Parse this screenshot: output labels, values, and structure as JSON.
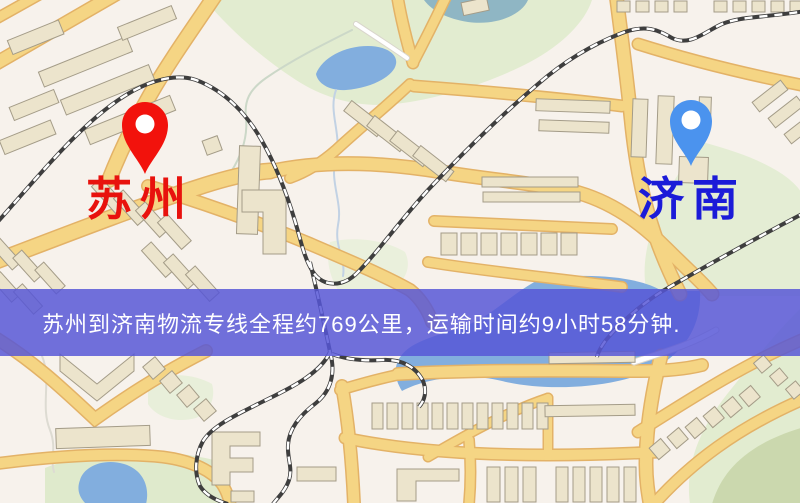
{
  "map": {
    "markers": [
      {
        "id": "origin",
        "label": "苏州",
        "label_color": "#e8120d",
        "pin_color": "#f2120c"
      },
      {
        "id": "destination",
        "label": "济南",
        "label_color": "#1b1bd8",
        "pin_color": "#4b93ee"
      }
    ],
    "palette": {
      "background": "#f7f2ec",
      "road_fill": "#f5d584",
      "road_casing": "#e3b267",
      "park": "#e2ecd0",
      "water": "#82aede",
      "building": "#ece4cc",
      "railway": "#3e3e3e",
      "banner_background": "#5656d6"
    }
  },
  "banner": {
    "text": "苏州到济南物流专线全程约769公里，运输时间约9小时58分钟."
  },
  "route": {
    "origin": "苏州",
    "destination": "济南",
    "distance_text": "约769公里",
    "duration_text": "约9小时58分钟"
  }
}
